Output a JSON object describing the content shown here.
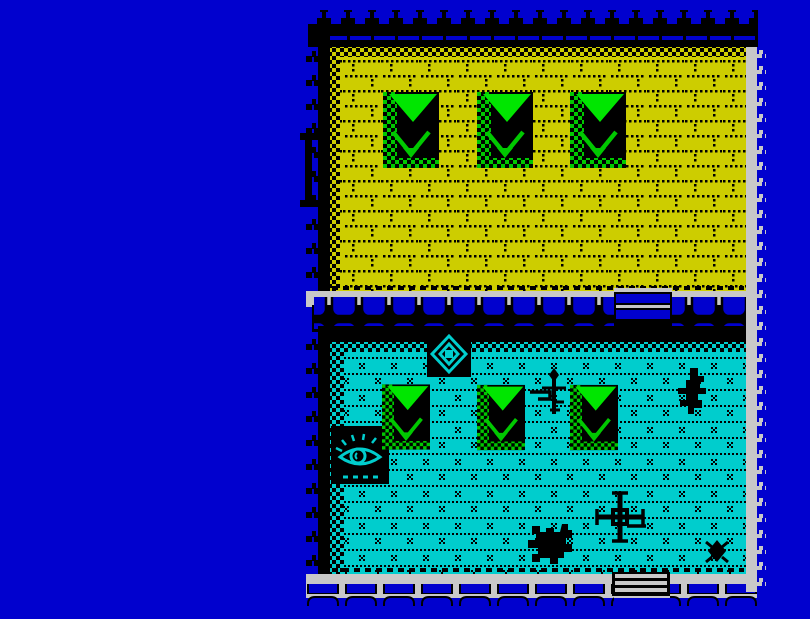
{
  "meta": {
    "type": "zx-spectrum-game-screenshot",
    "visible_text": []
  },
  "palette": {
    "background_blue": "#0101CE",
    "wall_black": "#000000",
    "stone_white": "#C8C8C8",
    "floor_yellow": "#CDCD00",
    "floor_cyan": "#00CDCD",
    "furniture_green": "#00C800",
    "furniture_bright_green": "#00E600"
  },
  "scene": {
    "rooms": [
      {
        "id": "top-room",
        "floor": "yellow",
        "contents": "three green beds, left doorway"
      },
      {
        "id": "bottom-room",
        "floor": "cyan",
        "contents": "three green beds, shield tile, eye tile, creatures, two doorways"
      }
    ],
    "sprites": [
      {
        "type": "bed",
        "x": 383,
        "y": 92,
        "w": 56,
        "h": 76
      },
      {
        "type": "bed",
        "x": 477,
        "y": 92,
        "w": 56,
        "h": 76
      },
      {
        "type": "bed",
        "x": 570,
        "y": 92,
        "w": 56,
        "h": 76
      },
      {
        "type": "door-left",
        "x": 300,
        "y": 133,
        "w": 26,
        "h": 74
      },
      {
        "type": "door-mid",
        "x": 614,
        "y": 288,
        "w": 58,
        "h": 42
      },
      {
        "type": "shield-tile",
        "x": 427,
        "y": 331,
        "w": 44,
        "h": 46
      },
      {
        "type": "eye-tile",
        "x": 331,
        "y": 426,
        "w": 58,
        "h": 58
      },
      {
        "type": "bed",
        "x": 382,
        "y": 381,
        "w": 48,
        "h": 72
      },
      {
        "type": "bed",
        "x": 477,
        "y": 382,
        "w": 48,
        "h": 71
      },
      {
        "type": "bed",
        "x": 570,
        "y": 382,
        "w": 48,
        "h": 71
      },
      {
        "type": "dagger",
        "x": 528,
        "y": 368,
        "w": 40,
        "h": 52
      },
      {
        "type": "bat",
        "x": 676,
        "y": 368,
        "w": 38,
        "h": 46
      },
      {
        "type": "windmill",
        "x": 594,
        "y": 490,
        "w": 52,
        "h": 54
      },
      {
        "type": "turtle",
        "x": 524,
        "y": 516,
        "w": 56,
        "h": 52
      },
      {
        "type": "bug",
        "x": 702,
        "y": 538,
        "w": 30,
        "h": 28
      },
      {
        "type": "door-bottom",
        "x": 612,
        "y": 572,
        "w": 58,
        "h": 24
      }
    ]
  }
}
